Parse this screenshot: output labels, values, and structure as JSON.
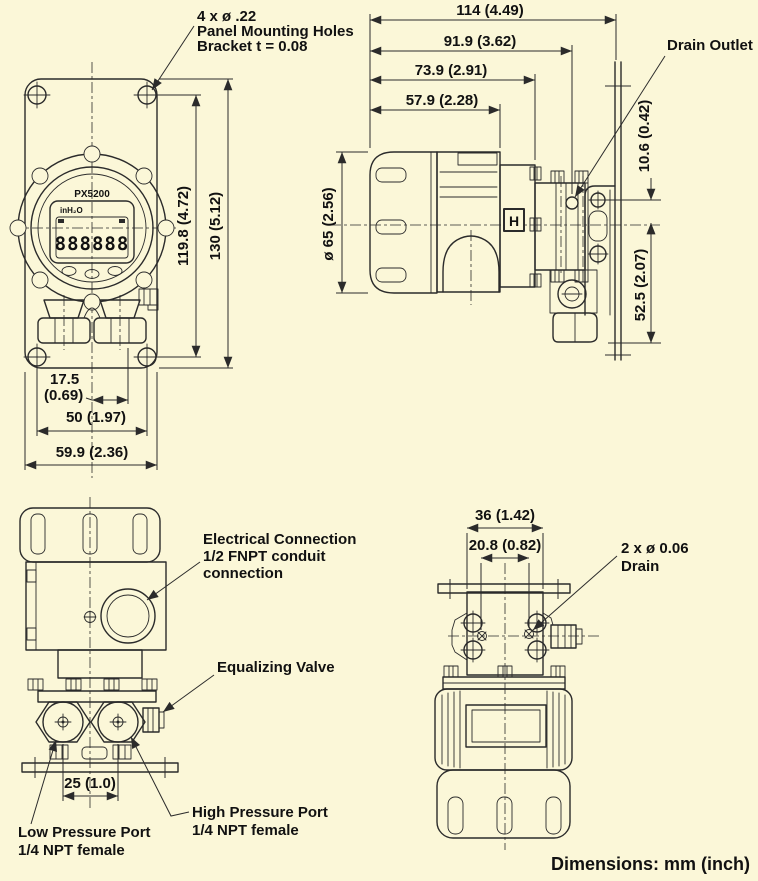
{
  "page": {
    "background": "#FBF7D8",
    "line_color": "#2B2B2B",
    "text_color": "#111111",
    "footer": "Dimensions: mm (inch)"
  },
  "front_view": {
    "note": {
      "line1": "4 x ø .22",
      "line2": "Panel Mounting Holes",
      "line3": "Bracket t = 0.08"
    },
    "display": {
      "model": "PX5200",
      "unit": "inH₂O",
      "digits": "888888"
    },
    "dims": {
      "hole_height": "119.8 (4.72)",
      "overall_height": "130 (5.12)",
      "port_offset": "17.5",
      "port_offset_inch": "(0.69)",
      "hole_spacing": "50 (1.97)",
      "overall_width": "59.9 (2.36)"
    }
  },
  "side_view": {
    "dims": {
      "overall_length": "114 (4.49)",
      "to_drain": "91.9 (3.62)",
      "to_terminal": "73.9 (2.91)",
      "to_body": "57.9 (2.28)",
      "cover_diameter": "ø 65 (2.56)",
      "hole_offset": "10.6 (0.42)",
      "port_drop": "52.5 (2.07)"
    },
    "labels": {
      "drain_outlet": "Drain Outlet",
      "high_marker": "H"
    }
  },
  "rear_view": {
    "labels": {
      "electrical1": "Electrical Connection",
      "electrical2": "1/2 FNPT conduit",
      "electrical3": "connection",
      "equalizing": "Equalizing Valve",
      "high1": "High Pressure Port",
      "high2": "1/4 NPT female",
      "low1": "Low Pressure Port",
      "low2": "1/4 NPT female"
    },
    "dims": {
      "port_spacing": "25 (1.0)"
    }
  },
  "top_view": {
    "dims": {
      "bracket_width": "36 (1.42)",
      "drain_spacing": "20.8 (0.82)"
    },
    "labels": {
      "drain1": "2 x ø 0.06",
      "drain2": "Drain"
    }
  }
}
